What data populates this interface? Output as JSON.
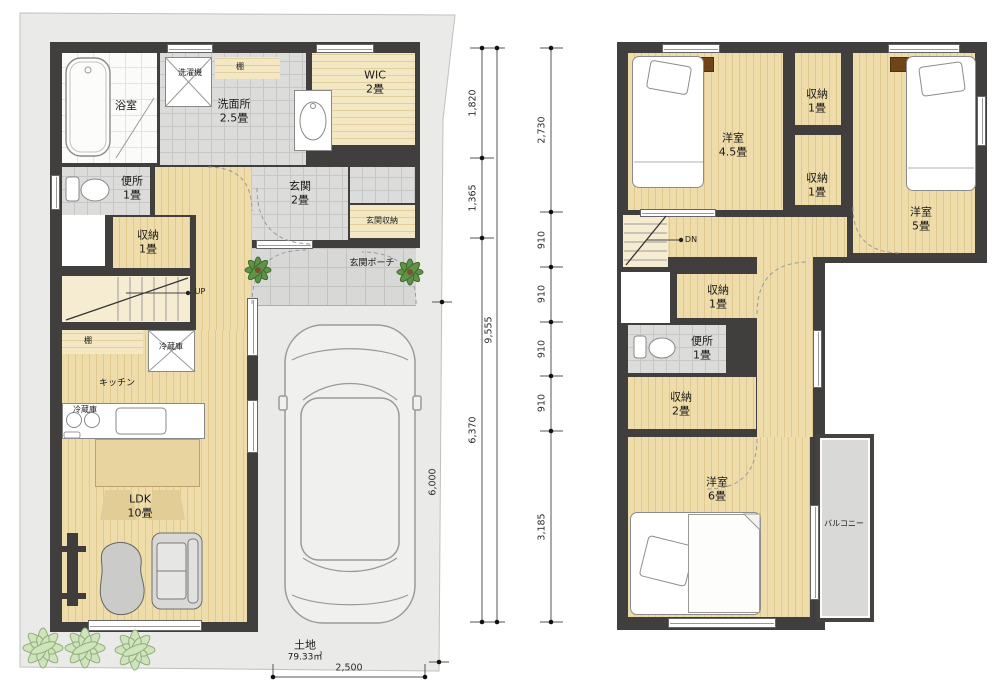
{
  "title": "2-story house floor plan",
  "colors": {
    "wall": "#413f3e",
    "wood_floor": "#eeddab",
    "shelf_wood": "#f3e7c4",
    "tile": "#dcdcda",
    "site": "#eaeae8",
    "plant_light": "#bcd6a4",
    "plant_dark": "#5f9348",
    "accent_brown": "#6f4418"
  },
  "floor1": {
    "bath": {
      "label": "浴室"
    },
    "laundry": {
      "label": "洗濯機"
    },
    "shelf_top": {
      "label": "棚"
    },
    "washroom": {
      "label": "洗面所",
      "size": "2.5畳"
    },
    "wic": {
      "label": "WIC",
      "size": "2畳"
    },
    "toilet": {
      "label": "便所",
      "size": "1畳"
    },
    "entrance": {
      "label": "玄関",
      "size": "2畳"
    },
    "entrance_storage": {
      "label": "玄関収納"
    },
    "closet": {
      "label": "収納",
      "size": "1畳"
    },
    "porch": {
      "label": "玄関ポーチ"
    },
    "stairs_label": "UP",
    "kitchen_shelf": {
      "label": "棚"
    },
    "fridge": {
      "label": "冷蔵庫"
    },
    "kitchen": {
      "label": "キッチン"
    },
    "counter_fridge": {
      "label": "冷蔵庫"
    },
    "ldk": {
      "label": "LDK",
      "size": "10畳"
    },
    "lot": {
      "label": "土地",
      "area": "79.33㎡"
    }
  },
  "floor2": {
    "bedroom_45": {
      "label": "洋室",
      "size": "4.5畳"
    },
    "closet_a": {
      "label": "収納",
      "size": "1畳"
    },
    "closet_b": {
      "label": "収納",
      "size": "1畳"
    },
    "bedroom_5": {
      "label": "洋室",
      "size": "5畳"
    },
    "stairs_label": "DN",
    "closet_c": {
      "label": "収納",
      "size": "1畳"
    },
    "toilet": {
      "label": "便所",
      "size": "1畳"
    },
    "closet_d": {
      "label": "収納",
      "size": "2畳"
    },
    "bedroom_6": {
      "label": "洋室",
      "size": "6畳"
    },
    "balcony": {
      "label": "バルコニー"
    }
  },
  "dimensions": {
    "left_chain": [
      "1,820",
      "1,365",
      "6,370"
    ],
    "left_total": "9,555",
    "lot_edge": "6,000",
    "right_chain": [
      "2,730",
      "910",
      "910",
      "910",
      "910",
      "3,185"
    ],
    "bottom_width": "2,500"
  }
}
